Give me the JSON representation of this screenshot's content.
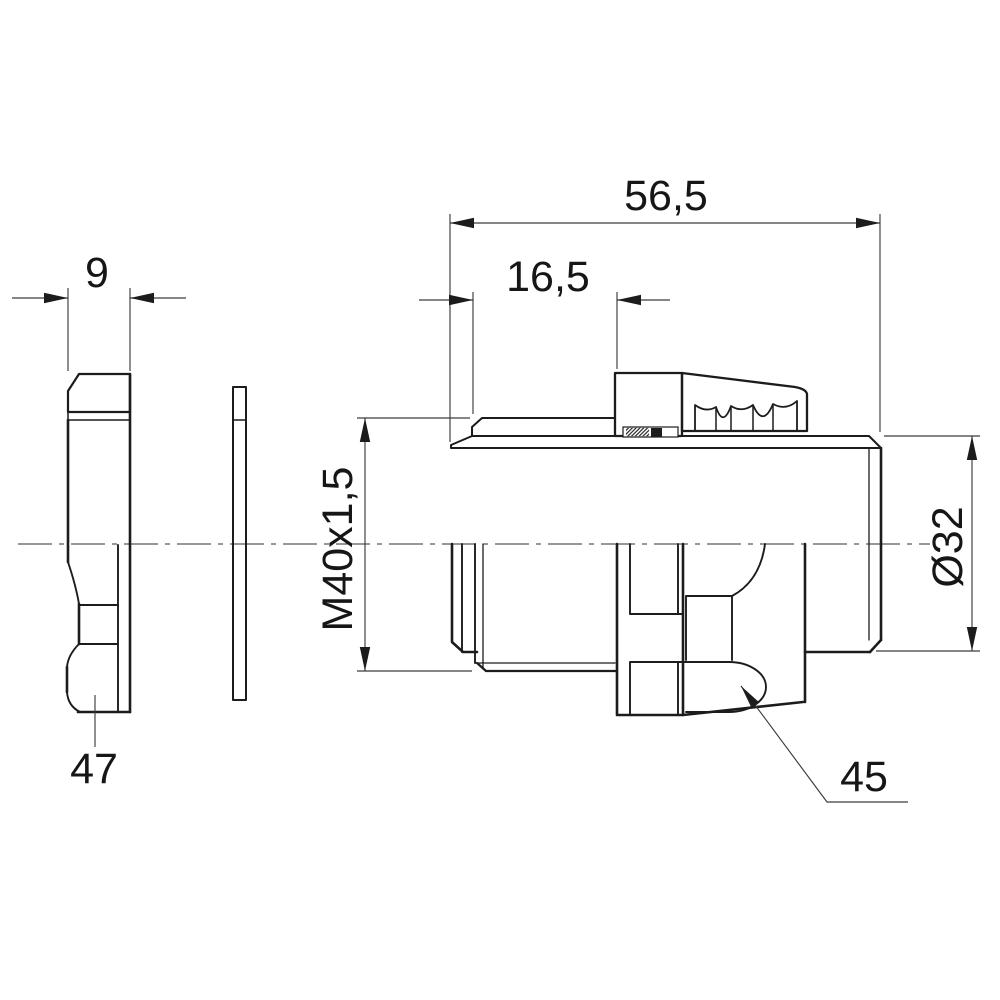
{
  "drawing": {
    "kind": "technical-drawing-cable-gland",
    "colors": {
      "line": "#1c1c1c",
      "dim_line": "#3c3c3c",
      "text": "#161616",
      "background": "#ffffff"
    },
    "dimensions": {
      "nut_width": "9",
      "total_length": "56,5",
      "thread_length": "16,5",
      "thread_spec": "M40x1,5",
      "outlet_diameter": "Ø32",
      "locknut_ref": "47",
      "seal_ref": "45"
    }
  }
}
